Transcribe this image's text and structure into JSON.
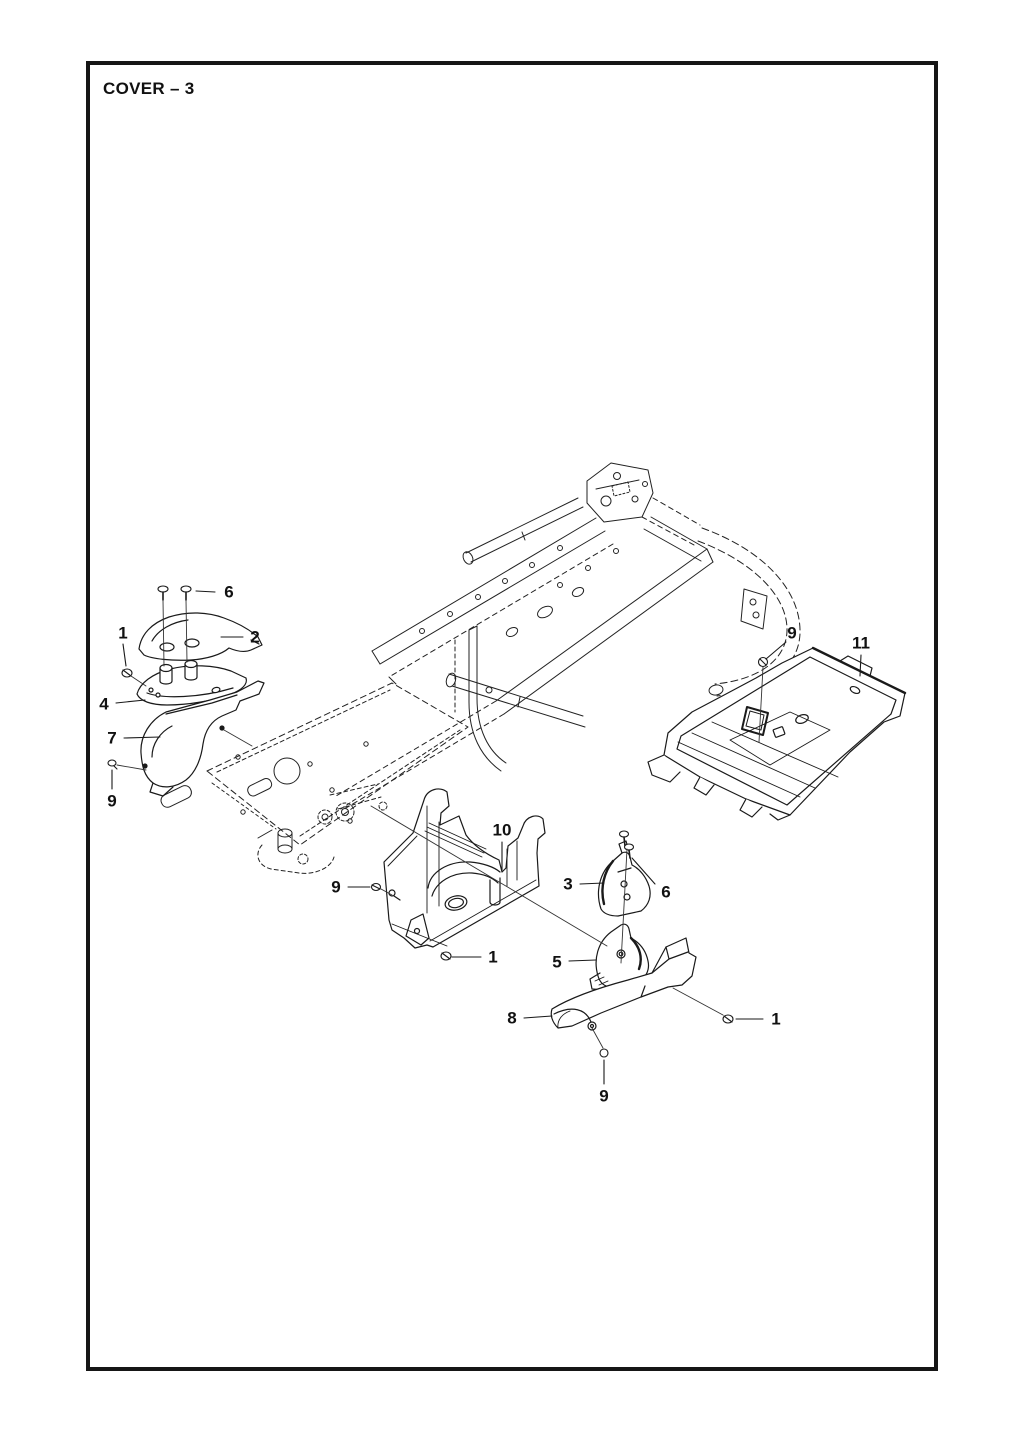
{
  "page": {
    "title": "COVER – 3"
  },
  "diagram": {
    "line_color": "#1a1a1a",
    "callouts": [
      {
        "label": "6",
        "x": 229,
        "y": 592,
        "leader": [
          215,
          592,
          196,
          591
        ]
      },
      {
        "label": "1",
        "x": 123,
        "y": 633,
        "leader": [
          123,
          644,
          126,
          666
        ]
      },
      {
        "label": "2",
        "x": 255,
        "y": 637,
        "leader": [
          243,
          637,
          221,
          637
        ]
      },
      {
        "label": "4",
        "x": 104,
        "y": 704,
        "leader": [
          116,
          703,
          145,
          700
        ]
      },
      {
        "label": "7",
        "x": 112,
        "y": 738,
        "leader": [
          124,
          738,
          160,
          737
        ]
      },
      {
        "label": "9",
        "x": 112,
        "y": 801,
        "leader": [
          112,
          789,
          112,
          770
        ]
      },
      {
        "label": "9",
        "x": 792,
        "y": 633,
        "leader": [
          786,
          642,
          766,
          659
        ]
      },
      {
        "label": "11",
        "x": 861,
        "y": 643,
        "leader": [
          861,
          655,
          860,
          676
        ]
      },
      {
        "label": "9",
        "x": 336,
        "y": 887,
        "leader": [
          348,
          887,
          370,
          887
        ]
      },
      {
        "label": "10",
        "x": 502,
        "y": 830,
        "leader": [
          502,
          842,
          502,
          870
        ]
      },
      {
        "label": "1",
        "x": 493,
        "y": 957,
        "leader": [
          481,
          957,
          452,
          957
        ]
      },
      {
        "label": "3",
        "x": 568,
        "y": 884,
        "leader": [
          580,
          884,
          604,
          883
        ]
      },
      {
        "label": "6",
        "x": 666,
        "y": 892,
        "leader": [
          655,
          884,
          632,
          858
        ]
      },
      {
        "label": "5",
        "x": 557,
        "y": 962,
        "leader": [
          569,
          961,
          596,
          960
        ]
      },
      {
        "label": "8",
        "x": 512,
        "y": 1018,
        "leader": [
          524,
          1018,
          552,
          1016
        ]
      },
      {
        "label": "1",
        "x": 776,
        "y": 1019,
        "leader": [
          763,
          1019,
          736,
          1019
        ]
      },
      {
        "label": "9",
        "x": 604,
        "y": 1096,
        "leader": [
          604,
          1084,
          604,
          1060
        ]
      }
    ]
  }
}
